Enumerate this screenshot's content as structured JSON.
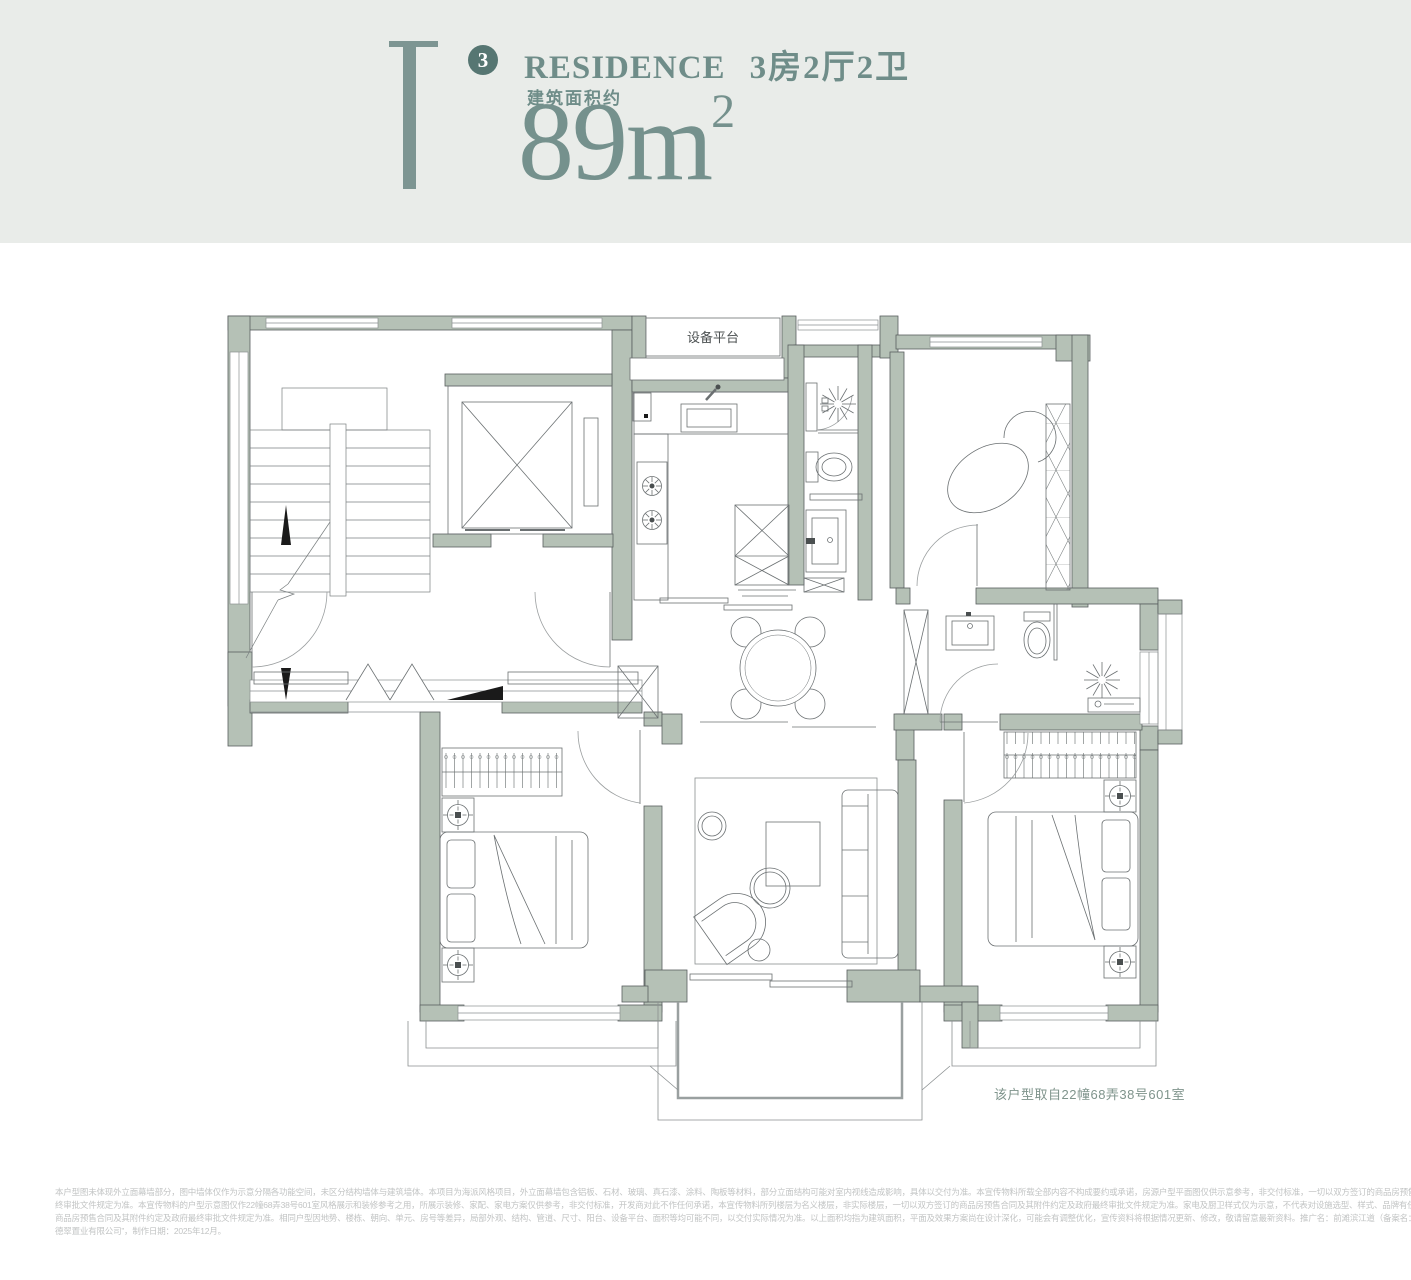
{
  "colors": {
    "header_bg": "#e9ece9",
    "accent": "#6f8d89",
    "accent_dark": "#567672",
    "accent_light": "#7d9592",
    "wall_fill": "#b5c1b6",
    "wall_stroke": "#595e5f",
    "caption_text": "#7f948c",
    "disclaimer_text": "#c2c4c4"
  },
  "header": {
    "unit_number": "3",
    "title_en": "RESIDENCE",
    "title_cn": "3房2厅2卫",
    "area_label": "建筑面积约",
    "area_value": "89m",
    "area_exponent": "2"
  },
  "plan": {
    "platform_label": "设备平台",
    "caption": "该户型取自22幢68弄38号601室"
  },
  "disclaimer": {
    "lines": [
      "本户型图未体现外立面幕墙部分，图中墙体仅作为示意分隔各功能空间，未区分结构墙体与建筑墙体。本项目为海派风格项目，外立面幕墙包含铝板、石材、玻璃、真石漆、涂料、陶板等材料，部分立面结构可能对室内视线造成影响，具体以交付为准。本宣传物料所载全部内容不构成要约或承诺，房源户型平面图仅供示意参考，非交付标准，一切以双方签订的商品房预售合同及其附件约定及政府最",
      "终审批文件规定为准。本宣传物料的户型示意图仅作22幢68弄38号601室风格展示和装修参考之用，所展示装修、家配、家电方案仅供参考，非交付标准，开发商对此不作任何承诺，本宣传物料所列楼层为名义楼层，非实际楼层，一切以双方签订的商品房预售合同及其附件约定及政府最终审批文件规定为准。家电及厨卫样式仅为示意，不代表对设施选型、样式、品牌有任何承诺，一切以双方签订的",
      "商品房预售合同及其附件约定及政府最终审批文件规定为准。相同户型因地势、楼栋、朝向、单元、房号等差异，局部外观、结构、管道、尺寸、阳台、设备平台、面积等均可能不同，以交付实际情况为准。以上面积均指为建筑面积，平面及效果方案尚在设计深化，可能会有调整优化，宣传资料将根据情况更新、修改，敬请留意最新资料。推广名：前滩滨江道（备案名：翠峰峻庭），开发公司为：“上海",
      "德翠置业有限公司”，制作日期：2025年12月。"
    ]
  }
}
